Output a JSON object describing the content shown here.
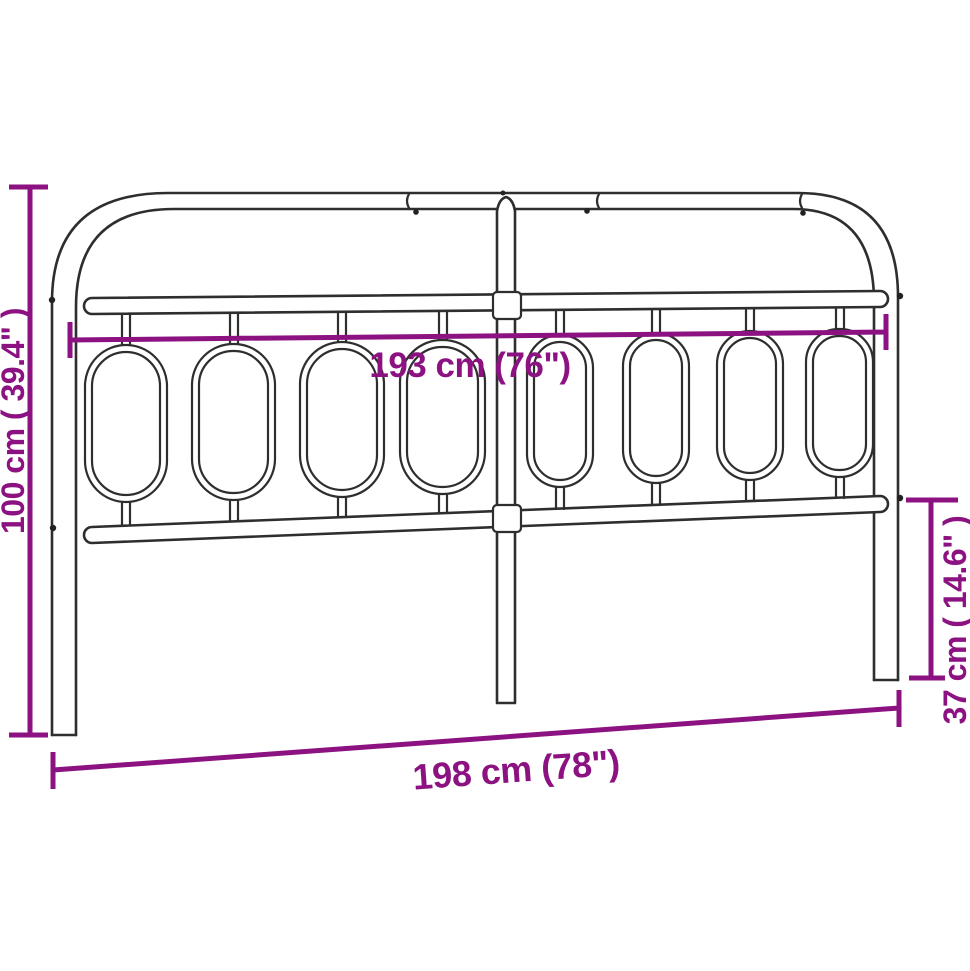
{
  "image": {
    "title": "Metal headboard dimension diagram",
    "background_color": "#ffffff",
    "outline_color": "#2e2e2e",
    "dimension_color": "#8C1282"
  },
  "dimensions": {
    "width_inner": "193 cm (76\")",
    "width_outer": "198 cm (78\")",
    "height_total": "100 cm ( 39.4\" )",
    "height_lower": "37 cm ( 14.6\" )"
  },
  "structure": {
    "oval_count": 8,
    "posts": 3,
    "rails": [
      "top rail",
      "upper rail",
      "lower rail"
    ]
  }
}
